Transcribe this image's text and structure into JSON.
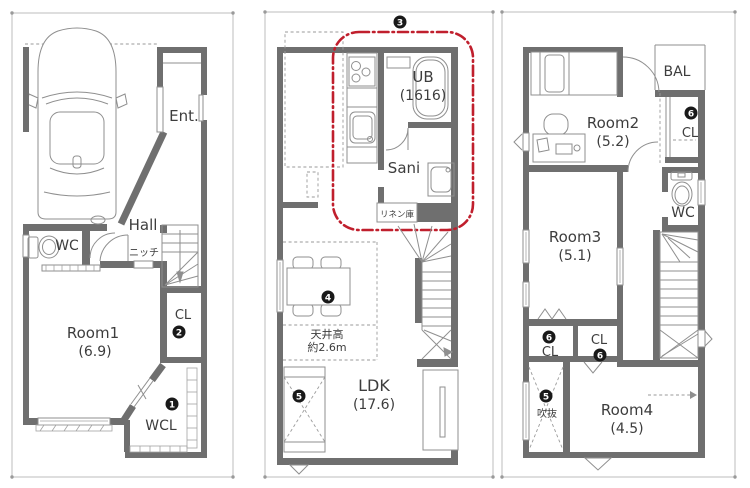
{
  "colors": {
    "wall": "#6f6f6f",
    "thin_line": "#8f8f8f",
    "site_boundary": "#bdbdbd",
    "feature_zone_red": "#c01f2d",
    "text": "#3d3d3d",
    "marker_circle": "#191919",
    "background": "#ffffff"
  },
  "f1": {
    "ent": "Ent.",
    "hall": "Hall",
    "wc": "WC",
    "niche": "ニッチ",
    "cl": "CL",
    "room1": "Room1",
    "room1_size": "(6.9)",
    "wcl": "WCL",
    "m1": "1",
    "m2": "2"
  },
  "f2": {
    "m3": "3",
    "ub": "UB",
    "ub_size": "(1616)",
    "sani": "Sani",
    "linen": "リネン庫",
    "m4": "4",
    "ceiling1": "天井高",
    "ceiling2": "約2.6m",
    "ldk": "LDK",
    "ldk_size": "(17.6)",
    "m5": "5"
  },
  "f3": {
    "bal": "BAL",
    "room2": "Room2",
    "room2_size": "(5.2)",
    "m6a": "6",
    "cl_a": "CL",
    "wc": "WC",
    "room3": "Room3",
    "room3_size": "(5.1)",
    "m6b": "6",
    "cl_b": "CL",
    "cl_c": "CL",
    "m6c": "6",
    "m5": "5",
    "void": "吹抜",
    "room4": "Room4",
    "room4_size": "(4.5)"
  }
}
